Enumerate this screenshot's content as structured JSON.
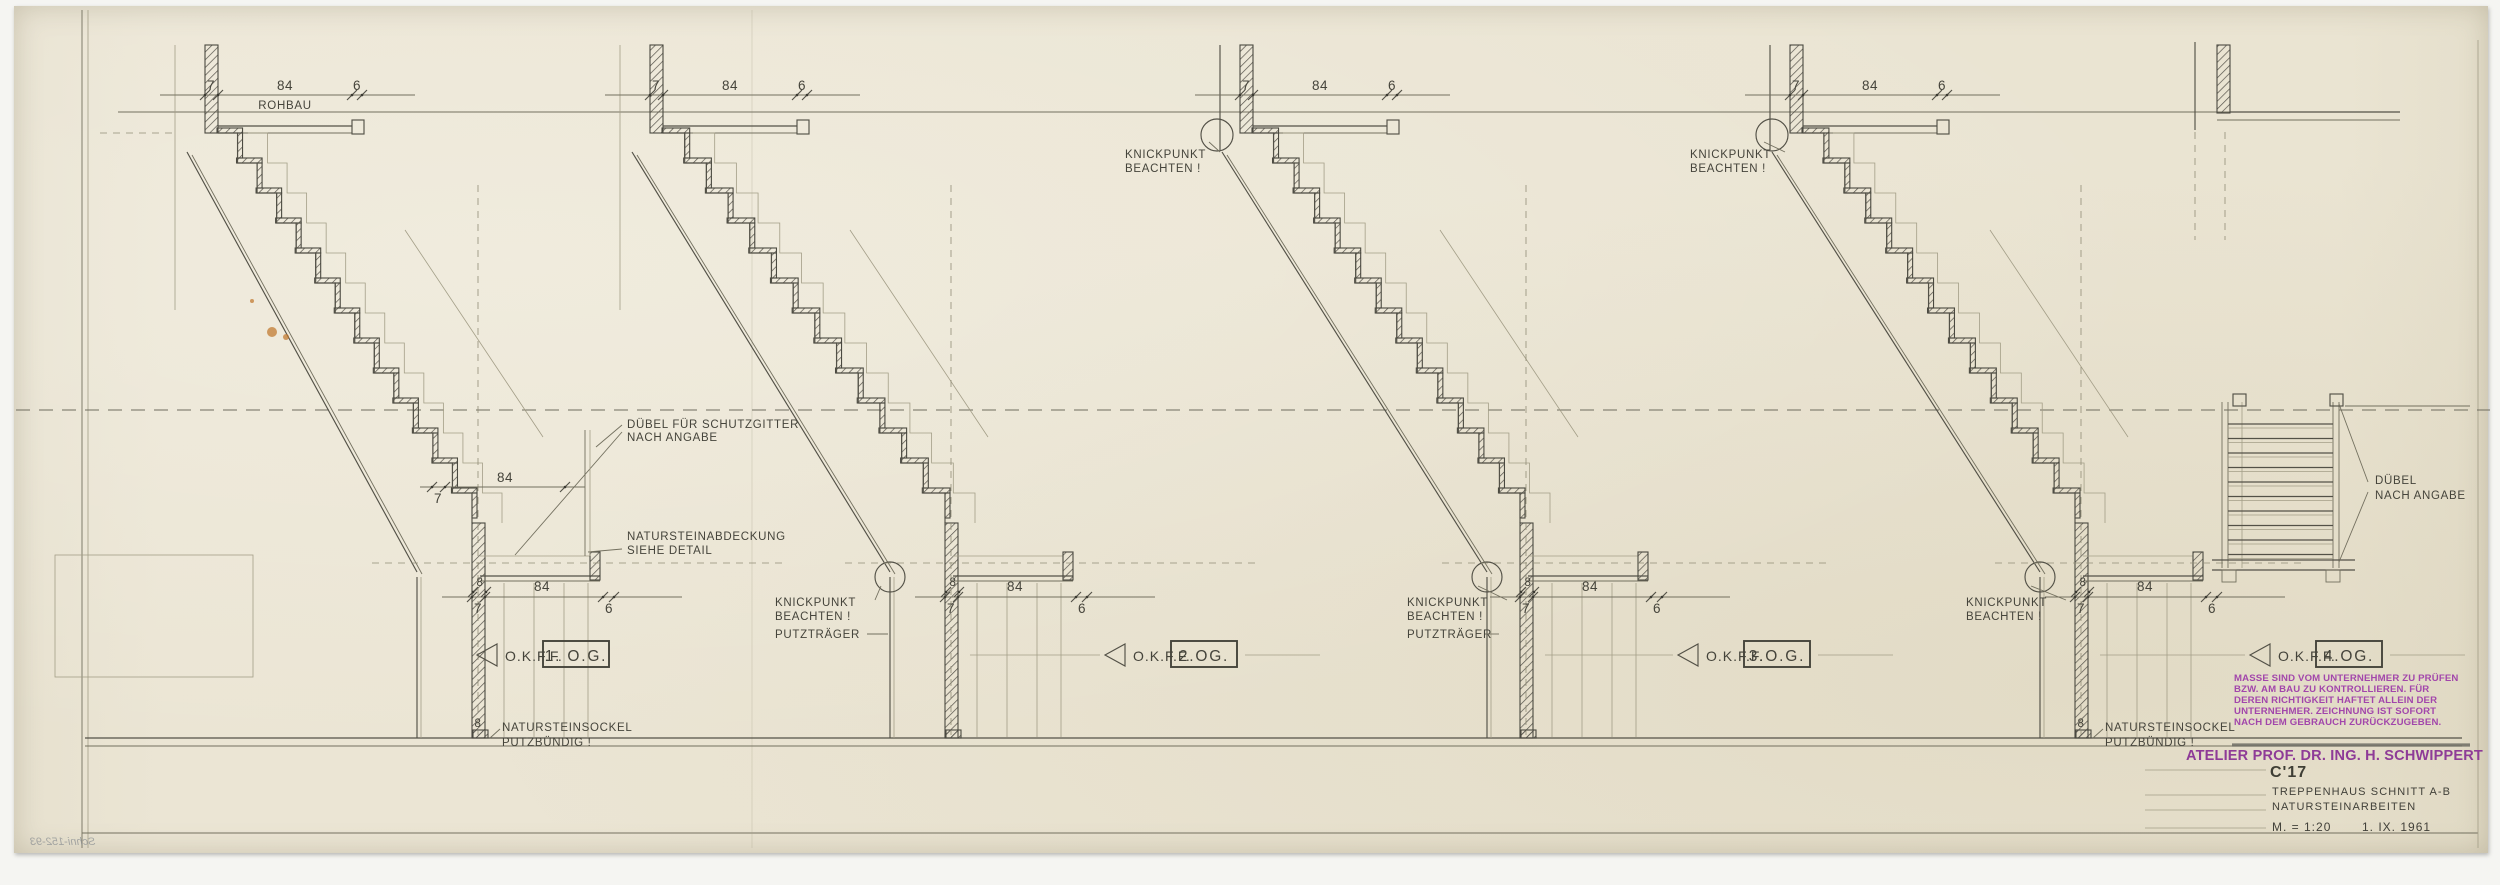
{
  "colors": {
    "paper": "#eae4d2",
    "line_dark": "#3b3a32",
    "stamp_purple": "#9c42a5",
    "stain_orange": "#bf7326"
  },
  "labels": {
    "rohbau": "ROHBAU",
    "dims": {
      "d7": "7",
      "d84": "84",
      "d6": "6",
      "d8": "8"
    },
    "okff": "O.K.F.F.",
    "floors": [
      "1. O.G.",
      "2.OG.",
      "3.O.G.",
      "4.OG."
    ],
    "knickpunkt": [
      "KNICKPUNKT",
      "BEACHTEN !"
    ],
    "putztraeger": "PUTZTRÄGER",
    "duebel_schutzgitter": [
      "DÜBEL FÜR SCHUTZGITTER",
      "NACH ANGABE"
    ],
    "naturstein_abdeckung": [
      "NATURSTEINABDECKUNG",
      "SIEHE DETAIL"
    ],
    "naturstein_sockel": [
      "NATURSTEINSOCKEL",
      "PUTZBÜNDIG !"
    ],
    "duebel_nach_angabe": [
      "DÜBEL",
      "NACH ANGABE"
    ]
  },
  "stamp": {
    "notice_lines": [
      "MASSE SIND VOM UNTERNEHMER ZU PRÜFEN",
      "BZW. AM BAU ZU KONTROLLIEREN. FÜR",
      "DEREN RICHTIGKEIT HAFTET ALLEIN DER",
      "UNTERNEHMER. ZEICHNUNG IST SOFORT",
      "NACH DEM GEBRAUCH ZURÜCKZUGEBEN."
    ],
    "atelier": "ATELIER PROF. DR. ING. H. SCHWIPPERT"
  },
  "title_block": {
    "code": "C'17",
    "title": "TREPPENHAUS SCHNITT A-B",
    "subtitle": "NATURSTEINARBEITEN",
    "scale": "M. = 1:20",
    "date": "1. IX. 1961"
  },
  "annotations": {
    "pencil_note": "Schni-152-93"
  }
}
